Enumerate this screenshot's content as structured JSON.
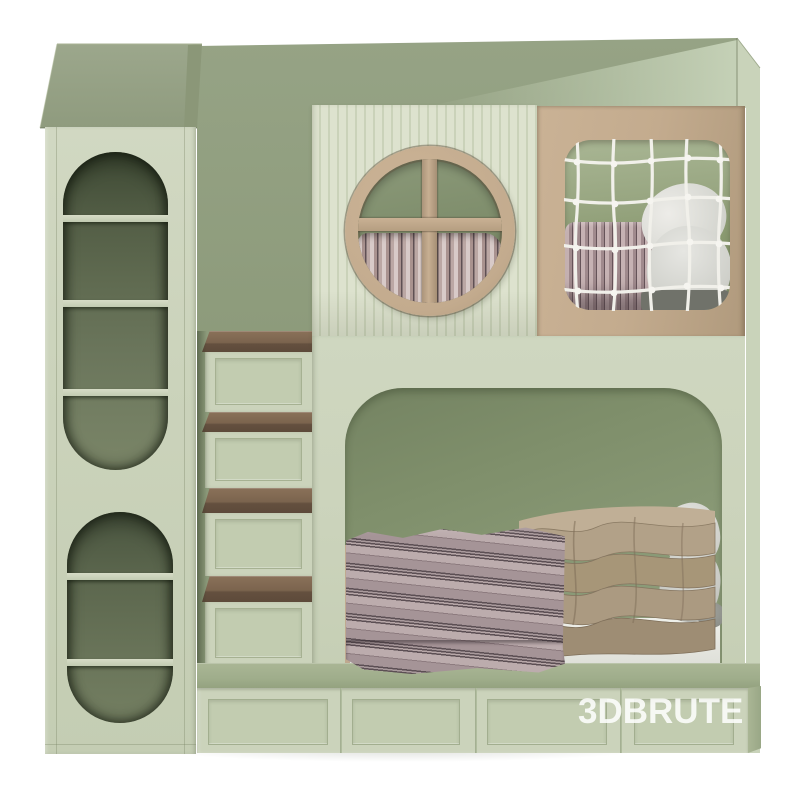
{
  "scene": {
    "title": "Kids house-frame bunk bed with storage — 3D product render",
    "background": "#ffffff",
    "watermark": {
      "text": "3DBRUTE",
      "color": "#ffffff",
      "opacity": 0.85
    }
  },
  "palette": {
    "face": "#cbd3bb",
    "face_light": "#dde2ce",
    "wall": "#909e7e",
    "wall_dark": "#7e8d6b",
    "roof": "#9aa58a",
    "platform": "#9fad8b",
    "tan": "#c3ab8e",
    "wood": "#77614c",
    "niche": "#515c44",
    "net": "#f1f0ea",
    "blanket_mauve": "#9d8a8d",
    "quilt_taupe": "#a6957c",
    "pillow_white": "#e0e0dc"
  },
  "bed": {
    "left_cabinet": {
      "upper_niche_shelves": 3,
      "lower_niche_shelves": 2
    },
    "stairs": {
      "steps": 4,
      "tread_material": "wood-brown",
      "riser_style": "recessed-panel"
    },
    "top_bunk": {
      "round_window": {
        "frame": "tan-ring",
        "muntins": "cross",
        "curtain": "striped-mauve"
      },
      "net_window": {
        "cords_vertical": 5,
        "cords_horizontal": 4,
        "net_color": "white"
      }
    },
    "bottom_bunk": {
      "opening": "arched",
      "bedding": [
        "striped-mauve-blanket",
        "taupe-quilt",
        "white-pillows"
      ]
    },
    "base": {
      "drawer_panels": 4
    }
  }
}
